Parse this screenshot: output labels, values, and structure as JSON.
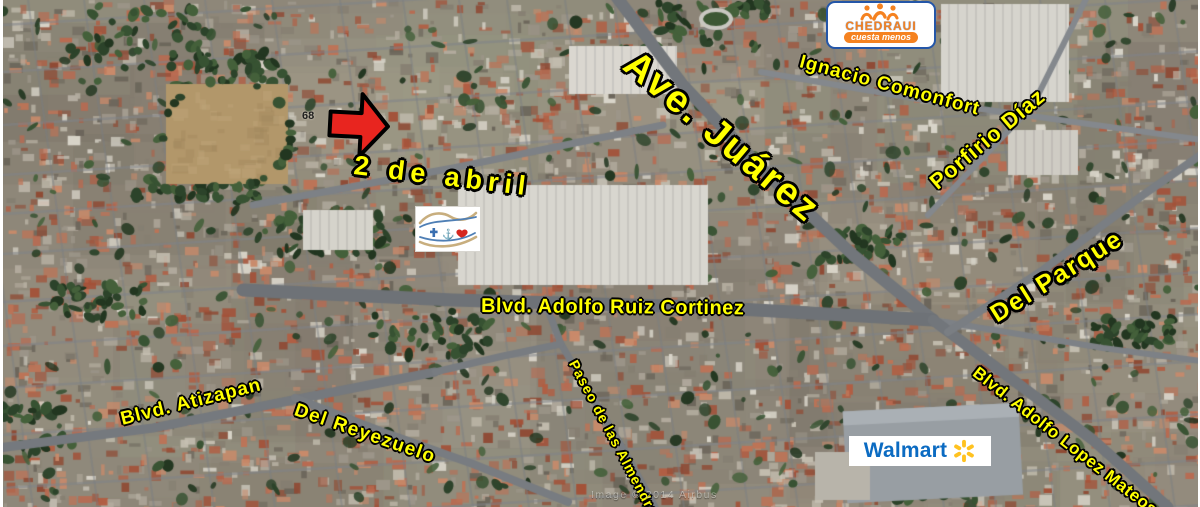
{
  "map": {
    "street_labels": {
      "ave_juarez": "Ave. Juárez",
      "ignacio_comonfort": "Ignacio Comonfort",
      "porfirio_diaz": "Porfirio Díaz",
      "dos_de_abril": "2 de abril",
      "ruiz_cortinez": "Blvd. Adolfo Ruiz Cortinez",
      "del_parque": "Del Parque",
      "atizapan": "Blvd. Atizapan",
      "del_reyezuelo": "Del Reyezuelo",
      "almendras": "Paseo de las Almendras",
      "lopez_mateos": "Blvd. Adolfo Lopez Mateos"
    },
    "street_number": "68",
    "logos": {
      "chedraui": {
        "brand": "CHEDRAUI",
        "tagline": "cuesta menos"
      },
      "walmart": {
        "brand": "Walmart"
      }
    },
    "watermark": "Image © 2014 Airbus",
    "colors": {
      "label_yellow": "#FFFF00",
      "label_outline": "#000000",
      "arrow_red": "#E8251F",
      "chedraui_orange": "#F58220",
      "chedraui_blue": "#2456A8",
      "walmart_blue": "#0B6BC2",
      "walmart_spark_yellow": "#FFC220"
    }
  }
}
